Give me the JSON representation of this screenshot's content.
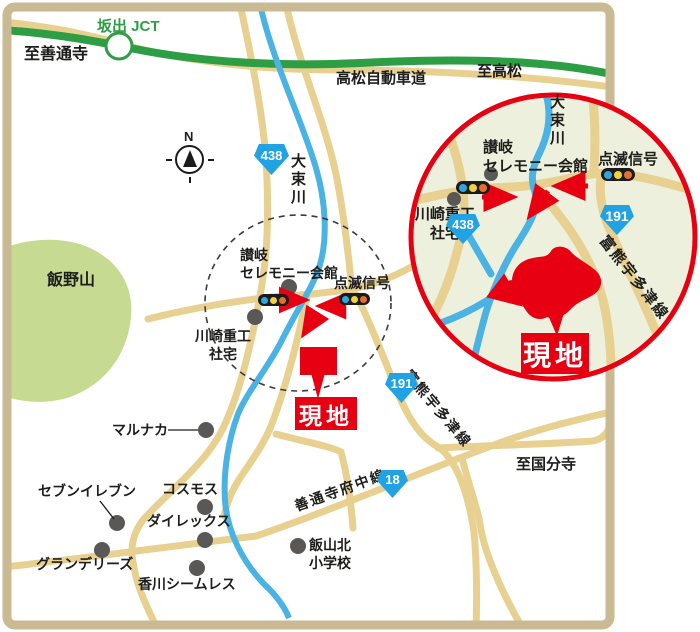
{
  "colors": {
    "frame_tan": "#c9ba94",
    "road_tan": "#e8d190",
    "expressway_green": "#2e9e44",
    "river_blue": "#4ab3e3",
    "mountain_green": "#c6da92",
    "inset_background": "#edf0dc",
    "accent_red": "#e60012",
    "route_badge_blue": "#21a3e3",
    "landmark_gray": "#5a5857"
  },
  "main_map": {
    "labels": {
      "to_zentsuji": "至善通寺",
      "sakaide_jct": "坂出 JCT",
      "takamatsu_expressway": "高松自動車道",
      "to_takamatsu": "至高松",
      "daisoku_river": "大束川",
      "iino_mountain": "飯野山",
      "north": "N",
      "sanuki_ceremony_line1": "讃岐",
      "sanuki_ceremony_line2": "セレモニー会館",
      "flashing_signal": "点滅信号",
      "kawasaki_line1": "川崎重工",
      "kawasaki_line2": "社宅",
      "site": "現地",
      "marunaka": "マルナカ",
      "seven_eleven": "セブンイレブン",
      "cosmos": "コスモス",
      "direx": "ダイレックス",
      "grandelys": "グランデリーズ",
      "kagawa_seamless": "香川シームレス",
      "hanzan_kita_line1": "飯山北",
      "hanzan_kita_line2": "小学校",
      "zentsuji_fuchu_line": "善通寺府中線",
      "to_kokubunji": "至国分寺",
      "tomikuma_utazu_line": "富熊宇多津線"
    },
    "route_numbers": {
      "r438": "438",
      "r191": "191",
      "r18": "18"
    }
  },
  "inset": {
    "labels": {
      "daisoku_river": "大束川",
      "sanuki_ceremony_line1": "讃岐",
      "sanuki_ceremony_line2": "セレモニー会館",
      "flashing_signal": "点滅信号",
      "kawasaki_line1": "川崎重工",
      "kawasaki_line2": "社宅",
      "tomikuma_utazu_line": "富熊宇多津線",
      "site": "現地"
    },
    "route_numbers": {
      "r438": "438",
      "r191": "191"
    }
  }
}
